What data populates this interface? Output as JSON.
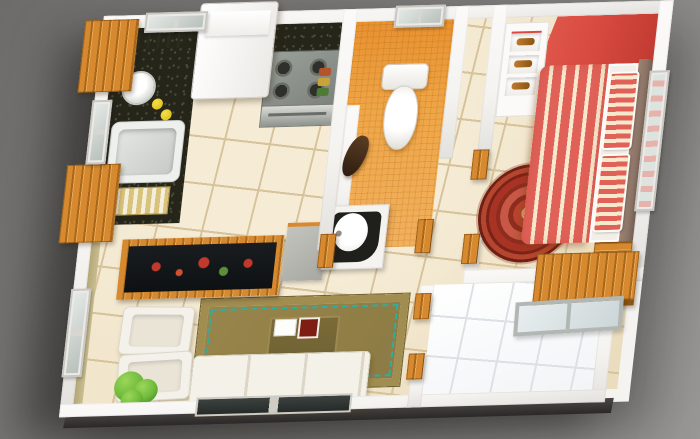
{
  "scene": {
    "type": "3d-floor-plan",
    "description": "Isometric 3D rendering of a one-bedroom apartment floor plan viewed from above, on a gray background",
    "rooms": [
      {
        "name": "kitchen",
        "position": "top-left",
        "furniture": [
          "upper-cabinets",
          "refrigerator",
          "stove",
          "oven",
          "kitchen-sink",
          "kettle",
          "lemons",
          "granite-counter",
          "dish-rack",
          "spice-jars",
          "window"
        ]
      },
      {
        "name": "bathroom",
        "position": "top-center",
        "furniture": [
          "toilet",
          "shower-head",
          "window",
          "orange-mosaic-tiles",
          "door-jambs"
        ]
      },
      {
        "name": "hallway",
        "position": "center",
        "furniture": [
          "corner-vanity-sink"
        ]
      },
      {
        "name": "bedroom",
        "position": "right",
        "furniture": [
          "red-accent-wall",
          "recessed-wall-shelves",
          "double-bed-striped",
          "pillows",
          "headboard",
          "round-red-rug",
          "nightstand",
          "wooden-desk",
          "side-window",
          "balcony-window"
        ]
      },
      {
        "name": "living-room",
        "position": "bottom-left",
        "furniture": [
          "tv-cabinet",
          "tv",
          "gray-cabinet",
          "armchair",
          "armchair",
          "sofa",
          "area-rug",
          "coffee-table",
          "potted-plant",
          "side-window",
          "bottom-window"
        ]
      },
      {
        "name": "balcony",
        "position": "bottom-right",
        "furniture": [
          "white-floor-tiles"
        ]
      }
    ]
  },
  "colors": {
    "bg1": "#6e6c6a",
    "bg2": "#8b8987",
    "wall": "#f4f3f0",
    "wall-shade": "#e3e1dd",
    "floor": "#eadcbd",
    "floor-hi": "#f6ecd6",
    "floor-grout": "#d6c29b",
    "bath-tile": "#efa647",
    "bath-wall": "#e8912f",
    "balcony-tile": "#f2f4f6",
    "balcony-grout": "#dde1e6",
    "red-wall": "#d84b40",
    "red-wall-dark": "#c03a31",
    "bed-red": "#e06158",
    "bed-cream": "#f6e9cd",
    "headboard": "#8b7466",
    "sheet": "#f2efe8",
    "wood": "#d6892f",
    "wood-dark": "#a9671c",
    "wood-hi": "#e9a953",
    "granite": "#25251a",
    "granite-fleck": "#4a4a35",
    "rug-gold": "#a18d50",
    "rug-field": "#8d7b45",
    "rug-teal": "#2fae9f",
    "rug-center": "#6f6233",
    "rug-red": "#a83325",
    "rug-red-dark": "#7c2318",
    "rug-red-light": "#c75845",
    "sofa": "#f4f1e8",
    "sofa-shade": "#ddd6c6",
    "plant": "#6fba3a",
    "plant-dark": "#3f7d1d",
    "khaki": "#b3a677"
  }
}
